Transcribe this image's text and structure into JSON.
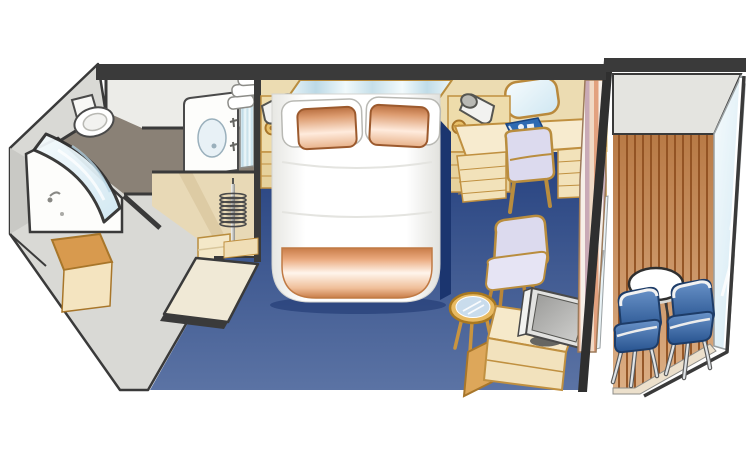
{
  "scene": {
    "kind": "cruise-ship-stateroom-floorplan",
    "style": "isometric-cutaway-illustration",
    "background": "#ffffff"
  },
  "palette": {
    "wall-dark": "#3a3a3a",
    "wall-gray": "#d9d9d5",
    "wall-gray-shade": "#c9c9c5",
    "bath-wall": "#ececе8",
    "bath-floor": "#8a8176",
    "wall-tan": "#ecdcb2",
    "furn-cream": "#f5e8cb",
    "furn-cream-deep": "#f2e2ba",
    "furn-amber": "#d89a4e",
    "outline-gold": "#c09040",
    "carpet-top": "#24407e",
    "carpet-bottom": "#5b73a4",
    "bed-white": "#ffffff",
    "pillow-peach": "#e0996c",
    "mirror-blue": "#cfe3ee",
    "folder-blue": "#2e6ab2",
    "wood-deck": "#c8874f",
    "wood-line": "#8f4f20",
    "balcony-glass": "#dff0f6",
    "chair-blue": "#3f6fae",
    "cushion-lavender": "#dcdaee",
    "tv-silver": "#e2e2e0",
    "door-cream": "#f0e9d6",
    "vestibule-tan": "#e8d9b6"
  },
  "rooms": [
    {
      "name": "bathroom",
      "items": [
        "toilet",
        "bathtub",
        "curved-glass-shower-screen",
        "sink-vanity",
        "vanity-mirror",
        "towel-stack",
        "faucet"
      ]
    },
    {
      "name": "closet-vestibule",
      "items": [
        "hanger-rail",
        "hangers-coil",
        "step-drawer",
        "entry-door",
        "door-threshold",
        "minibar-shelf"
      ]
    },
    {
      "name": "bedroom",
      "items": [
        "queen-bed",
        "white-pillow-left",
        "white-pillow-right",
        "peach-pillow-left",
        "peach-pillow-right",
        "peach-foot-blanket",
        "headboard-mirror-strip",
        "reading-lamp-left",
        "reading-lamp-right",
        "nightstand-left",
        "nightstand-right",
        "desk",
        "desk-mirror",
        "desk-chair",
        "blue-folder",
        "armchair",
        "glass-cocktail-table",
        "tv",
        "tv-cabinet",
        "striped-curtain",
        "sliding-glass-door"
      ]
    },
    {
      "name": "balcony",
      "items": [
        "bulkhead",
        "wood-plank-deck",
        "round-table",
        "deck-chair-left",
        "deck-chair-right",
        "glass-railing"
      ]
    }
  ]
}
